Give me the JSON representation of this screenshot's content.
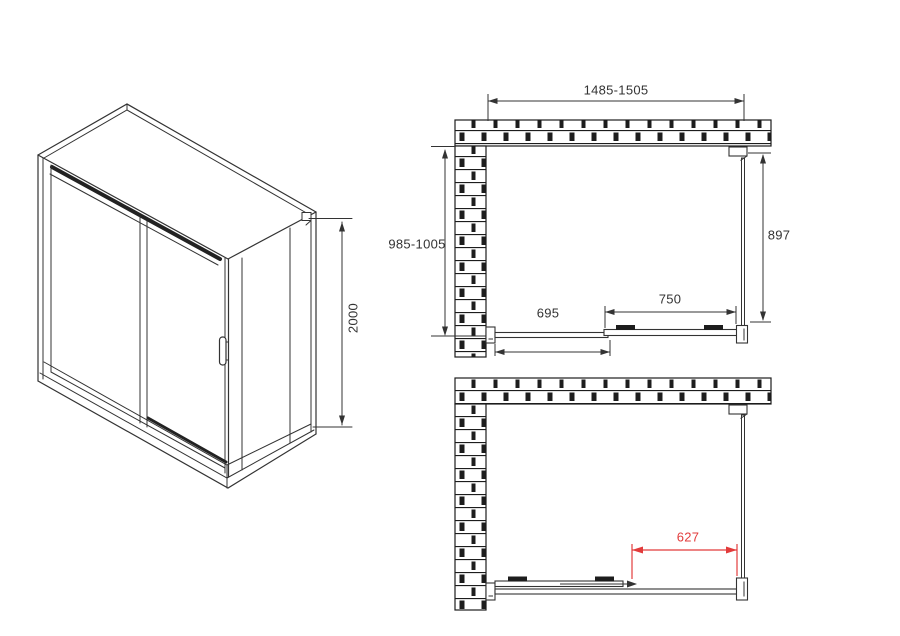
{
  "drawing": {
    "type": "shower-enclosure-technical-drawing",
    "views": {
      "perspective": {
        "height_label": "2000"
      },
      "plan_closed": {
        "width_label": "1485-1505",
        "depth_label": "985-1005",
        "side_panel_label": "897",
        "door_label": "750",
        "fixed_panel_label": "695"
      },
      "plan_open": {
        "opening_label": "627"
      }
    },
    "colors": {
      "line": "#333333",
      "dark_fill": "#1d1d1d",
      "accent_red": "#e23b3b",
      "background": "#ffffff"
    }
  }
}
